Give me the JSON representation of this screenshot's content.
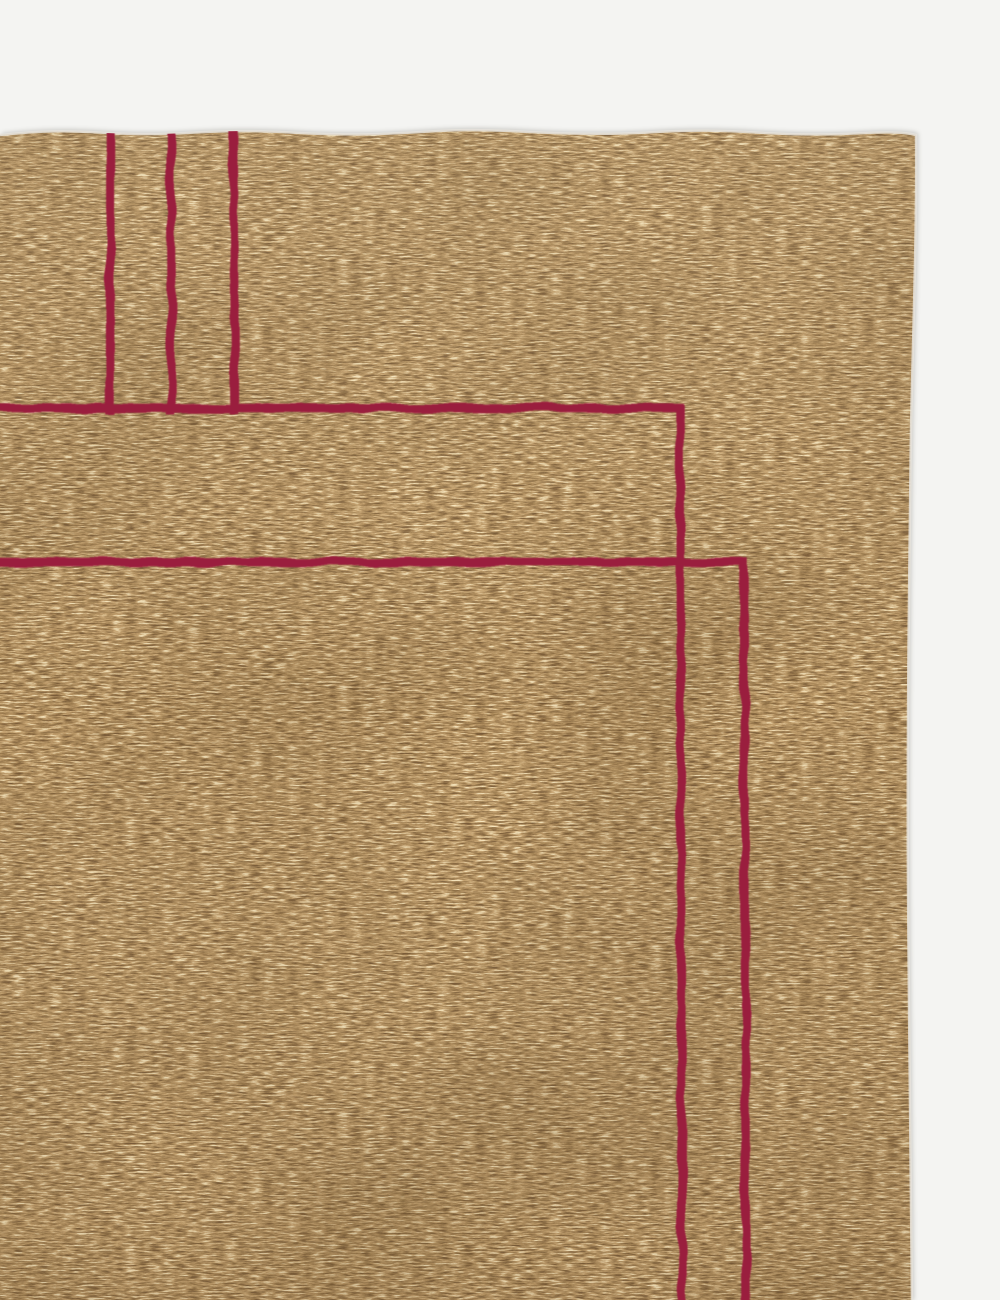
{
  "scene": {
    "type": "product-photo",
    "description": "Corner detail of a camel tan hand-loomed rug with minimalist wine red border lines, photographed flat on a white studio background"
  },
  "colors": {
    "background": "#f4f4f2",
    "rug_base": "#bfa176",
    "rug_highlight": "#e9d9b4",
    "rug_shadow": "#8f7349",
    "accent_line": "#9a1e3e",
    "edge_highlight": "#e6e3dc"
  },
  "rug": {
    "top_edge_y": 133,
    "right_edge_x": 915,
    "accent_pattern": {
      "vertical_line_x": [
        110,
        171,
        233
      ],
      "vertical_lines_end_y": 410,
      "outer_border": {
        "horizontal_y": 408,
        "corner_x": 680
      },
      "inner_border": {
        "horizontal_y": 562,
        "corner_x": 744
      },
      "line_width_px": 8.5
    }
  }
}
